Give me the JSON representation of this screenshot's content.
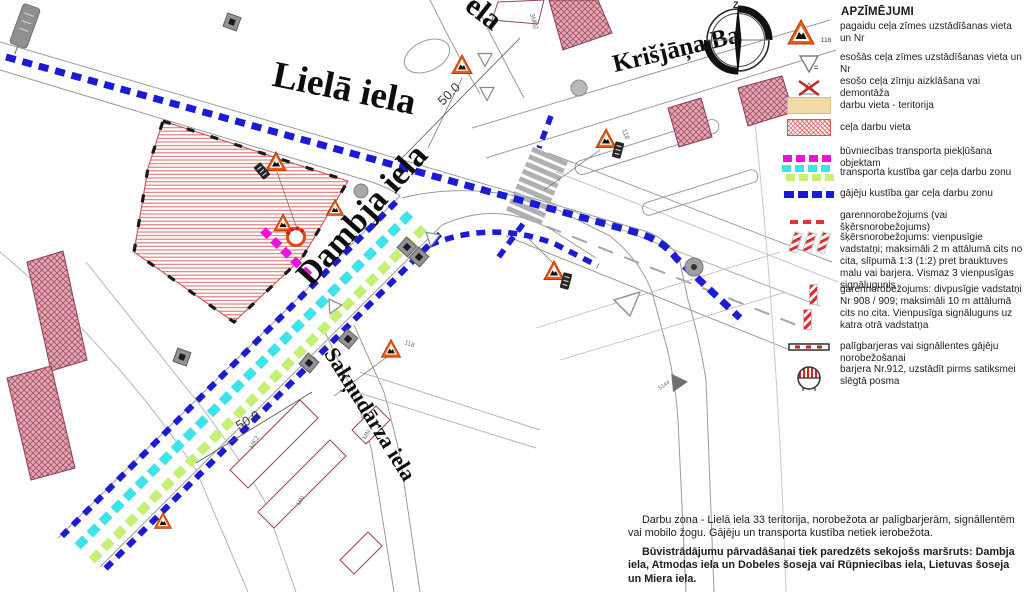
{
  "legend": {
    "title": "APZĪMĒJUMI",
    "compass_north": "Z",
    "items": [
      {
        "id": "temp-sign",
        "label": "pagaidu ceļa zīmes uzstādīšanas vieta un Nr",
        "badge": "118"
      },
      {
        "id": "existing-sign",
        "label": "esošās ceļa zīmes uzstādīšanas vieta un Nr"
      },
      {
        "id": "sign-removal",
        "label": "esošo ceļa zīmju aizklāšana vai demontāža"
      },
      {
        "id": "work-territory",
        "label": "darbu vieta - teritorija",
        "color": "#f2d9a8"
      },
      {
        "id": "road-works-area",
        "label": "ceļa darbu vieta",
        "color": "#d74646"
      },
      {
        "id": "construction-access",
        "label": "būvniecības transporta piekļūšana objektam",
        "color": "#ef12dd"
      },
      {
        "id": "traffic-route",
        "label": "transporta kustība gar ceļa darbu zonu",
        "colors": [
          "#3ae4ea",
          "#c8ef75"
        ]
      },
      {
        "id": "pedestrian-route",
        "label": "gājēju kustība gar ceļa darbu zonu",
        "color": "#1b1bd6"
      },
      {
        "id": "longitudinal-barrier-line",
        "label": "garennorobežojums (vai šķērsnorobežojums)",
        "color": "#e03434"
      },
      {
        "id": "cross-barrier-posts",
        "label": "šķērsnorobežojums: vienpusīgie vadstatņi; maksimāli 2 m attālumā cits no cita, slīpumā 1:3 (1:2) pret brauktuves malu vai barjera. Vismaz 3 vienpusīgas signālugunis"
      },
      {
        "id": "longitudinal-posts",
        "label": "garennorobežojums: divpusīgie vadstatņi Nr 908 / 909; maksimāli 10 m attālumā cits no cita. Vienpusīga signāluguns uz katra otrā vadstatņa"
      },
      {
        "id": "aux-barriers",
        "label": "palīgbarjeras vai signāllentes gājēju norobežošanai"
      },
      {
        "id": "barrier-912",
        "label": "barjera Nr.912, uzstādīt pirms satiksmei slēgtā posma"
      }
    ]
  },
  "map": {
    "street_labels": {
      "liela": "Lielā iela",
      "dambja": "Dambja iela",
      "saknudarza": "Sakņudārza iela",
      "krisjana_barona": "Krišjāņa Ba",
      "top_fragment": "ela"
    },
    "dimension_a": "50.0",
    "dimension_b": "50.0",
    "sign_118_a": "118",
    "sign_118_b": "118",
    "small_labels": {
      "l1": "3M02",
      "l2": "MK2",
      "l3": "MN",
      "l4": "MN",
      "l5": "5144"
    }
  },
  "notes": {
    "para1": "Darbu zona - Lielā iela 33 teritorija, norobežota ar palīgbarjerām, signāllentēm vai mobilo žogu. Gājēju un transporta kustība netiek ierobežota.",
    "para2": "Būvistrādājumu pārvadāšanai tiek paredzēts sekojošs maršruts: Dambja iela, Atmodas iela un Dobeles šoseja vai Rūpniecības iela, Lietuvas šoseja un Miera iela."
  },
  "colors": {
    "pedestrian_blue": "#1b1bd6",
    "traffic_cyan": "#3ae4ea",
    "traffic_green": "#c8ef75",
    "construction_magenta": "#ef12dd",
    "barrier_red": "#e03434",
    "zone_hatch_red": "#d86868",
    "building_rose": "#dfaab6",
    "temp_sign_orange": "#f15a10"
  }
}
